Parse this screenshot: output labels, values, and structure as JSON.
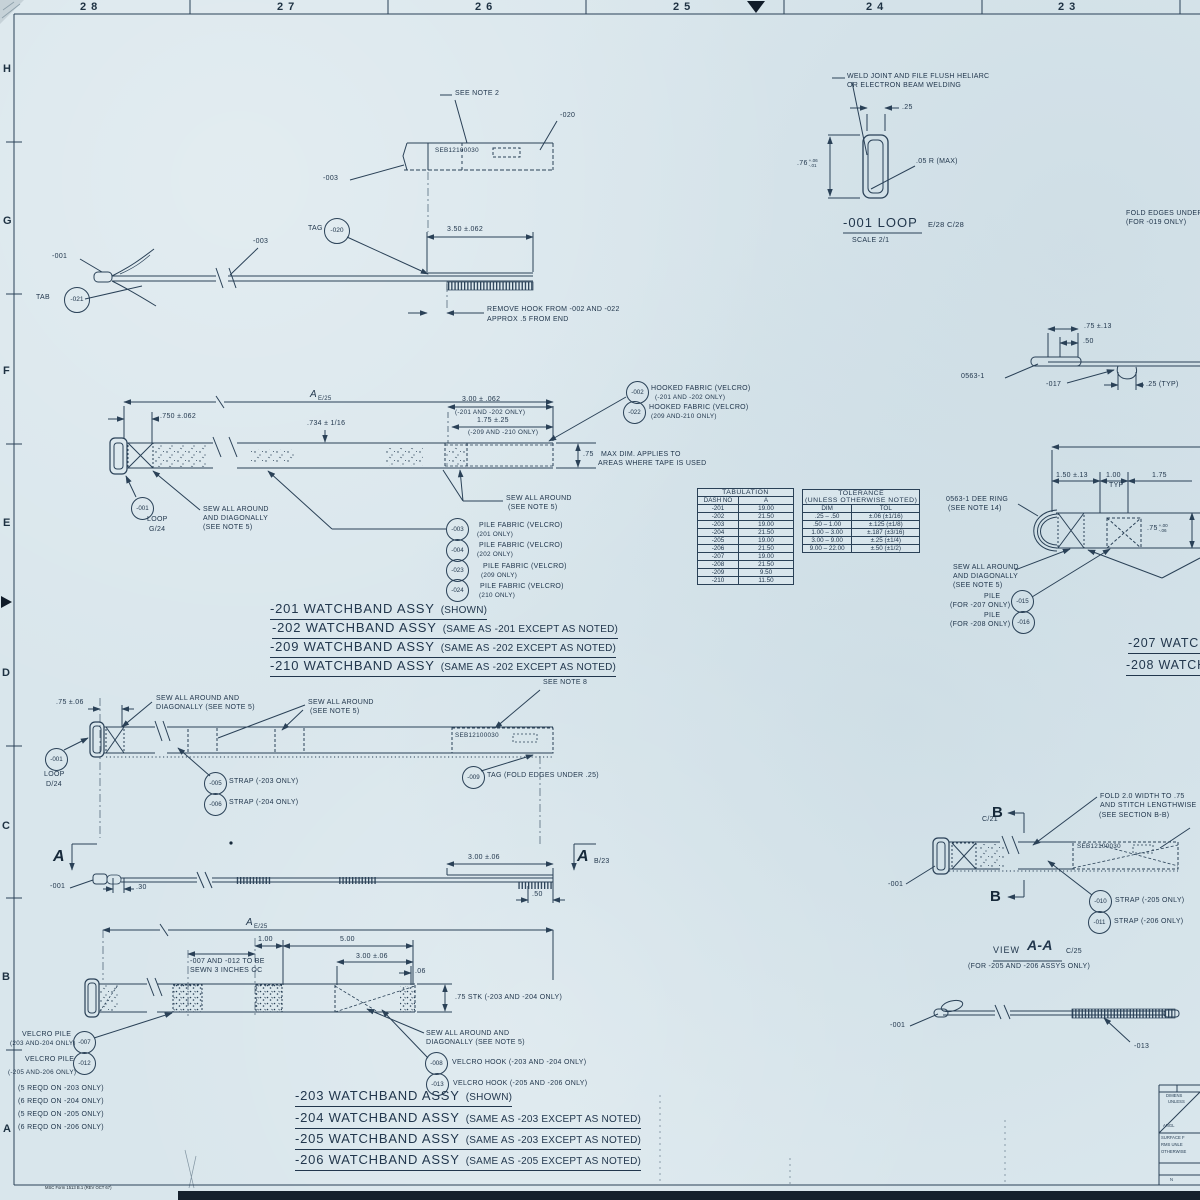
{
  "border": {
    "top_zones": [
      "28",
      "27",
      "26",
      "25",
      "24",
      "23"
    ],
    "side_zones": [
      "H",
      "G",
      "F",
      "E",
      "D",
      "C",
      "B",
      "A"
    ],
    "form_note": "MSC Form 1513 B.1 (REV OCT 67)"
  },
  "tag_detail": {
    "see_note": "SEE NOTE 2",
    "part_no": "SEB12100030",
    "label_020": "-020",
    "label_003": "-003"
  },
  "strap_view": {
    "label_001": "-001",
    "tab_label": "TAB",
    "balloon_021": "-021",
    "label_003": "-003",
    "tag_label": "TAG",
    "balloon_020": "-020",
    "dim_350": "3.50 ±.062",
    "remove_note_1": "REMOVE HOOK FROM -002 AND -022",
    "remove_note_2": "APPROX .5 FROM END"
  },
  "loop_detail": {
    "weld_note_1": "WELD JOINT AND FILE FLUSH HELIARC",
    "weld_note_2": "OR ELECTRON BEAM WELDING",
    "dim_25": ".25",
    "dim_76": ".76",
    "dim_76_plus": "+.06",
    "dim_76_minus": "-.01",
    "radius_note": ".05 R (MAX)",
    "title": "-001 LOOP",
    "refs": "E/28 C/28",
    "scale": "SCALE 2/1"
  },
  "fold_note": {
    "line1": "FOLD EDGES UNDER",
    "line2": "(FOR -019 ONLY)"
  },
  "assy201": {
    "dim_a": "A",
    "dim_a_ref": "E/25",
    "dim_750": ".750 ±.062",
    "dim_734": ".734 ± 1/16",
    "dim_300": "3.00 ± .062",
    "dim_300_note": "(-201 AND -202 ONLY)",
    "dim_175": "1.75 ±.25",
    "dim_175_note": "(-209 AND -210 ONLY)",
    "dim_75": ".75",
    "dim_75_note1": "MAX DIM. APPLIES TO",
    "dim_75_note2": "AREAS WHERE TAPE IS USED",
    "balloon_002": "-002",
    "hooked_1a": "HOOKED FABRIC (VELCRO)",
    "hooked_1b": "(-201 AND -202 ONLY)",
    "balloon_022": "-022",
    "hooked_2a": "HOOKED FABRIC (VELCRO)",
    "hooked_2b": "(209 AND-210 ONLY)",
    "balloon_001": "-001",
    "loop_label": "LOOP",
    "loop_ref": "G/24",
    "sew_1a": "SEW ALL AROUND",
    "sew_1b": "AND DIAGONALLY",
    "sew_1c": "(SEE NOTE 5)",
    "sew_2a": "SEW ALL AROUND",
    "sew_2b": "(SEE NOTE 5)",
    "pile": [
      {
        "balloon": "-003",
        "text": "PILE FABRIC (VELCRO)",
        "note": "(201 ONLY)"
      },
      {
        "balloon": "-004",
        "text": "PILE FABRIC (VELCRO)",
        "note": "(202 ONLY)"
      },
      {
        "balloon": "-023",
        "text": "PILE FABRIC (VELCRO)",
        "note": "(209 ONLY)"
      },
      {
        "balloon": "-024",
        "text": "PILE FABRIC (VELCRO)",
        "note": "(210 ONLY)"
      }
    ],
    "titles": [
      {
        "name": "-201 WATCHBAND ASSY",
        "note": "(SHOWN)"
      },
      {
        "name": "-202 WATCHBAND ASSY",
        "note": "(SAME AS -201 EXCEPT AS NOTED)"
      },
      {
        "name": "-209 WATCHBAND ASSY",
        "note": "(SAME AS -202 EXCEPT AS NOTED)"
      },
      {
        "name": "-210 WATCHBAND ASSY",
        "note": "(SAME AS -202 EXCEPT AS NOTED)"
      }
    ]
  },
  "tabulation": {
    "title": "TABULATION",
    "col1": "DASH NO",
    "col2": "A",
    "rows": [
      [
        "-201",
        "19.00"
      ],
      [
        "-202",
        "21.50"
      ],
      [
        "-203",
        "19.00"
      ],
      [
        "-204",
        "21.50"
      ],
      [
        "-205",
        "19.00"
      ],
      [
        "-206",
        "21.50"
      ],
      [
        "-207",
        "19.00"
      ],
      [
        "-208",
        "21.50"
      ],
      [
        "-209",
        "9.50"
      ],
      [
        "-210",
        "11.50"
      ]
    ]
  },
  "tolerance": {
    "title1": "TOLERANCE",
    "title2": "(UNLESS OTHERWISE NOTED)",
    "col1": "DIM",
    "col2": "TOL",
    "rows": [
      [
        ".25 – .50",
        "±.06 (±1/16)"
      ],
      [
        ".50 – 1.00",
        "±.125 (±1/8)"
      ],
      [
        "1.00 – 3.00",
        "±.187 (±3/16)"
      ],
      [
        "3.00 – 9.00",
        "±.25 (±1/4)"
      ],
      [
        "9.00 – 22.00",
        "±.50 (±1/2)"
      ]
    ]
  },
  "detail0563": {
    "dim_75": ".75 ±.13",
    "dim_50": ".50",
    "label": "0563-1",
    "label_017": "-017",
    "dim_25": ".25 (TYP)"
  },
  "assy207": {
    "dim_150": "1.50 ±.13",
    "dim_100": "1.00",
    "dim_100b": "TYP",
    "dim_175": "1.75",
    "dim_75": ".75",
    "dim_75_plus": "+.00",
    "dim_75_minus": "-.06",
    "dee_ring_1": "0563-1 DEE RING",
    "dee_ring_2": "(SEE NOTE 14)",
    "sew_1": "SEW ALL AROUND",
    "sew_2": "AND DIAGONALLY",
    "sew_3": "(SEE NOTE 5)",
    "pile_1a": "PILE",
    "pile_1b": "(FOR -207 ONLY)",
    "balloon_015": "-015",
    "pile_2a": "PILE",
    "pile_2b": "(FOR -208 ONLY)",
    "balloon_016": "-016",
    "title_207": "-207 WATCHBAND",
    "title_208": "-208 WATCHBAND"
  },
  "assy203": {
    "see_note_8": "SEE NOTE 8",
    "dim_75": ".75 ±.06",
    "sew_1a": "SEW ALL AROUND AND",
    "sew_1b": "DIAGONALLY (SEE NOTE 5)",
    "sew_2a": "SEW ALL AROUND",
    "sew_2b": "(SEE NOTE 5)",
    "part_no": "SEB12100030",
    "balloon_001": "-001",
    "loop_label": "LOOP",
    "loop_ref": "D/24",
    "balloon_005": "-005",
    "strap_005": "STRAP (-203 ONLY)",
    "balloon_006": "-006",
    "strap_006": "STRAP (-204 ONLY)",
    "balloon_009": "-009",
    "tag_note": "TAG (FOLD EDGES UNDER .25)"
  },
  "sectionAA": {
    "mark_left": "A",
    "mark_right": "A",
    "mark_right_ref": "B/23",
    "label_001": "-001",
    "dim_30": ".30",
    "dim_300": "3.00 ±.06",
    "dim_50": ".50"
  },
  "assy203b": {
    "dim_a": "A",
    "dim_a_ref": "E/25",
    "dim_100": "1.00",
    "dim_500": "5.00",
    "sew_note_1": "-007 AND -012 TO BE",
    "sew_note_2": "SEWN 3 INCHES OC",
    "dim_300": "3.00 ±.06",
    "dim_06": ".06",
    "dim_stk": ".75 STK (-203 AND -204 ONLY)",
    "pile_1a": "VELCRO PILE",
    "pile_1b": "(203 AND-204 ONLY)",
    "balloon_007": "-007",
    "pile_2a": "VELCRO PILE",
    "pile_2b": "(-205 AND-206 ONLY)",
    "balloon_012": "-012",
    "reqd": [
      "(5 REQD ON -203 ONLY)",
      "(6 REQD ON -204 ONLY)",
      "(5 REQD ON -205 ONLY)",
      "(6 REQD ON -206 ONLY)"
    ],
    "sew_1": "SEW ALL AROUND AND",
    "sew_2": "DIAGONALLY (SEE NOTE 5)",
    "balloon_008": "-008",
    "hook_008": "VELCRO HOOK (-203 AND -204 ONLY)",
    "balloon_013": "-013",
    "hook_013": "VELCRO HOOK (-205 AND -206 ONLY)",
    "titles": [
      {
        "name": "-203 WATCHBAND ASSY",
        "note": "(SHOWN)"
      },
      {
        "name": "-204 WATCHBAND ASSY",
        "note": "(SAME AS -203 EXCEPT AS NOTED)"
      },
      {
        "name": "-205 WATCHBAND ASSY",
        "note": "(SAME AS -203 EXCEPT AS NOTED)"
      },
      {
        "name": "-206 WATCHBAND ASSY",
        "note": "(SAME AS -205 EXCEPT AS NOTED)"
      }
    ]
  },
  "viewAA": {
    "ref_c21": "C/21",
    "mark_b_top": "B",
    "mark_b_bottom": "B",
    "fold_1": "FOLD 2.0 WIDTH TO .75",
    "fold_2": "AND STITCH LENGTHWISE",
    "fold_3": "(SEE SECTION B-B)",
    "part_no": "SEB12100030",
    "label_001": "-001",
    "balloon_010": "-010",
    "strap_010": "STRAP (-205 ONLY)",
    "balloon_011": "-011",
    "strap_011": "STRAP (-206 ONLY)",
    "title_view": "VIEW",
    "title_aa": "A-A",
    "title_ref": "C/25",
    "subtitle": "(FOR -205 AND -206 ASSYS ONLY)"
  },
  "side_view_bottom": {
    "label_001": "-001",
    "label_013": "-013"
  },
  "title_block": {
    "l1": "DIMENS",
    "l2": "UNLESS",
    "l3": "ANGL",
    "l4": "SURFACE F",
    "l5": "RMS UNLE",
    "l6": "OTHERWISE",
    "l7": "N"
  }
}
